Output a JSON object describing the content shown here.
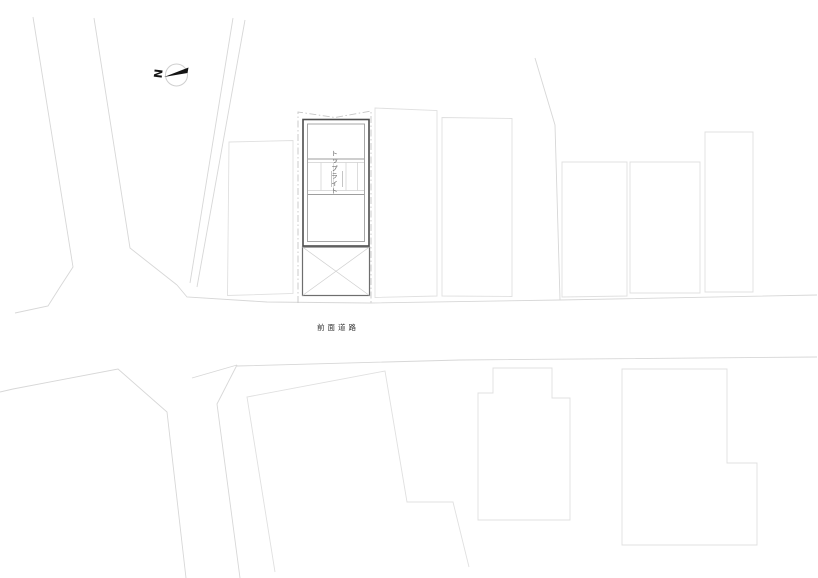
{
  "plan": {
    "labels": {
      "north": "N",
      "front_road": "前面道路",
      "skylight": "トップライト"
    },
    "colors": {
      "paper": "#ffffff",
      "faint_line": "#d7d7d7",
      "neighbor_line": "#e0e0e0",
      "site_boundary_line": "#c6c6c6",
      "main_wall_line": "#4d4d4d",
      "inner_wall_line": "#9e9e9e",
      "hatch_line": "#cfcfcf",
      "terrace_line": "#6e6e6e",
      "label_text": "#333333",
      "north_mark": "#141414"
    }
  }
}
